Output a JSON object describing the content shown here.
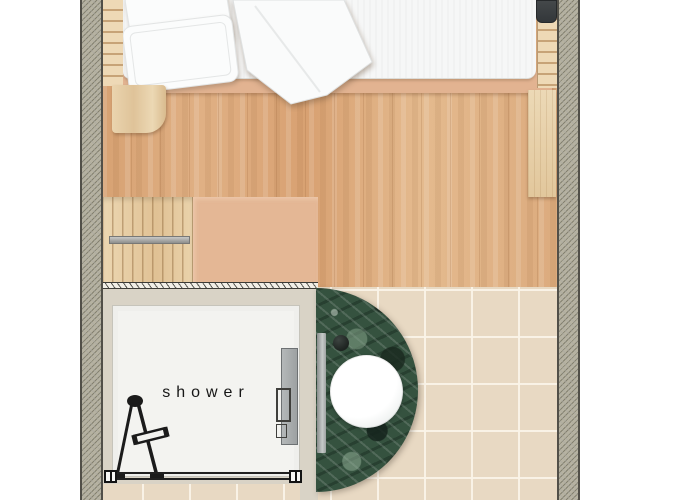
{
  "title": "Floor plan — bedroom with en-suite shower room",
  "labels": {
    "shower": "shower"
  },
  "colors": {
    "wall_hatch": "#b6b2a1",
    "wood_floor": "#ddab7d",
    "pine_wood": "#e9d4af",
    "bed_platform_tan": "#e2b391",
    "mattress_white": "#f6f7f7",
    "bathroom_tile": "#e8d9c3",
    "shower_tray": "#f3f3f0",
    "wall_greige": "#d9d3c6",
    "marble_green": "#35523f",
    "sink_white": "#ffffff",
    "dark_wall_unit": "#3b3e41",
    "metal_gray": "#a2a4a2"
  },
  "rooms": {
    "bedroom": {
      "items": [
        "double bed",
        "pillows",
        "duvet",
        "bedside table",
        "slatted rails",
        "dark wall unit",
        "side panel",
        "slatted deck",
        "cabinet"
      ]
    },
    "bathroom": {
      "items": [
        "shower tray",
        "shower fixture",
        "glass screen",
        "shower door panel",
        "green marble vanity",
        "round sink",
        "faucet",
        "tiled floor"
      ]
    }
  }
}
